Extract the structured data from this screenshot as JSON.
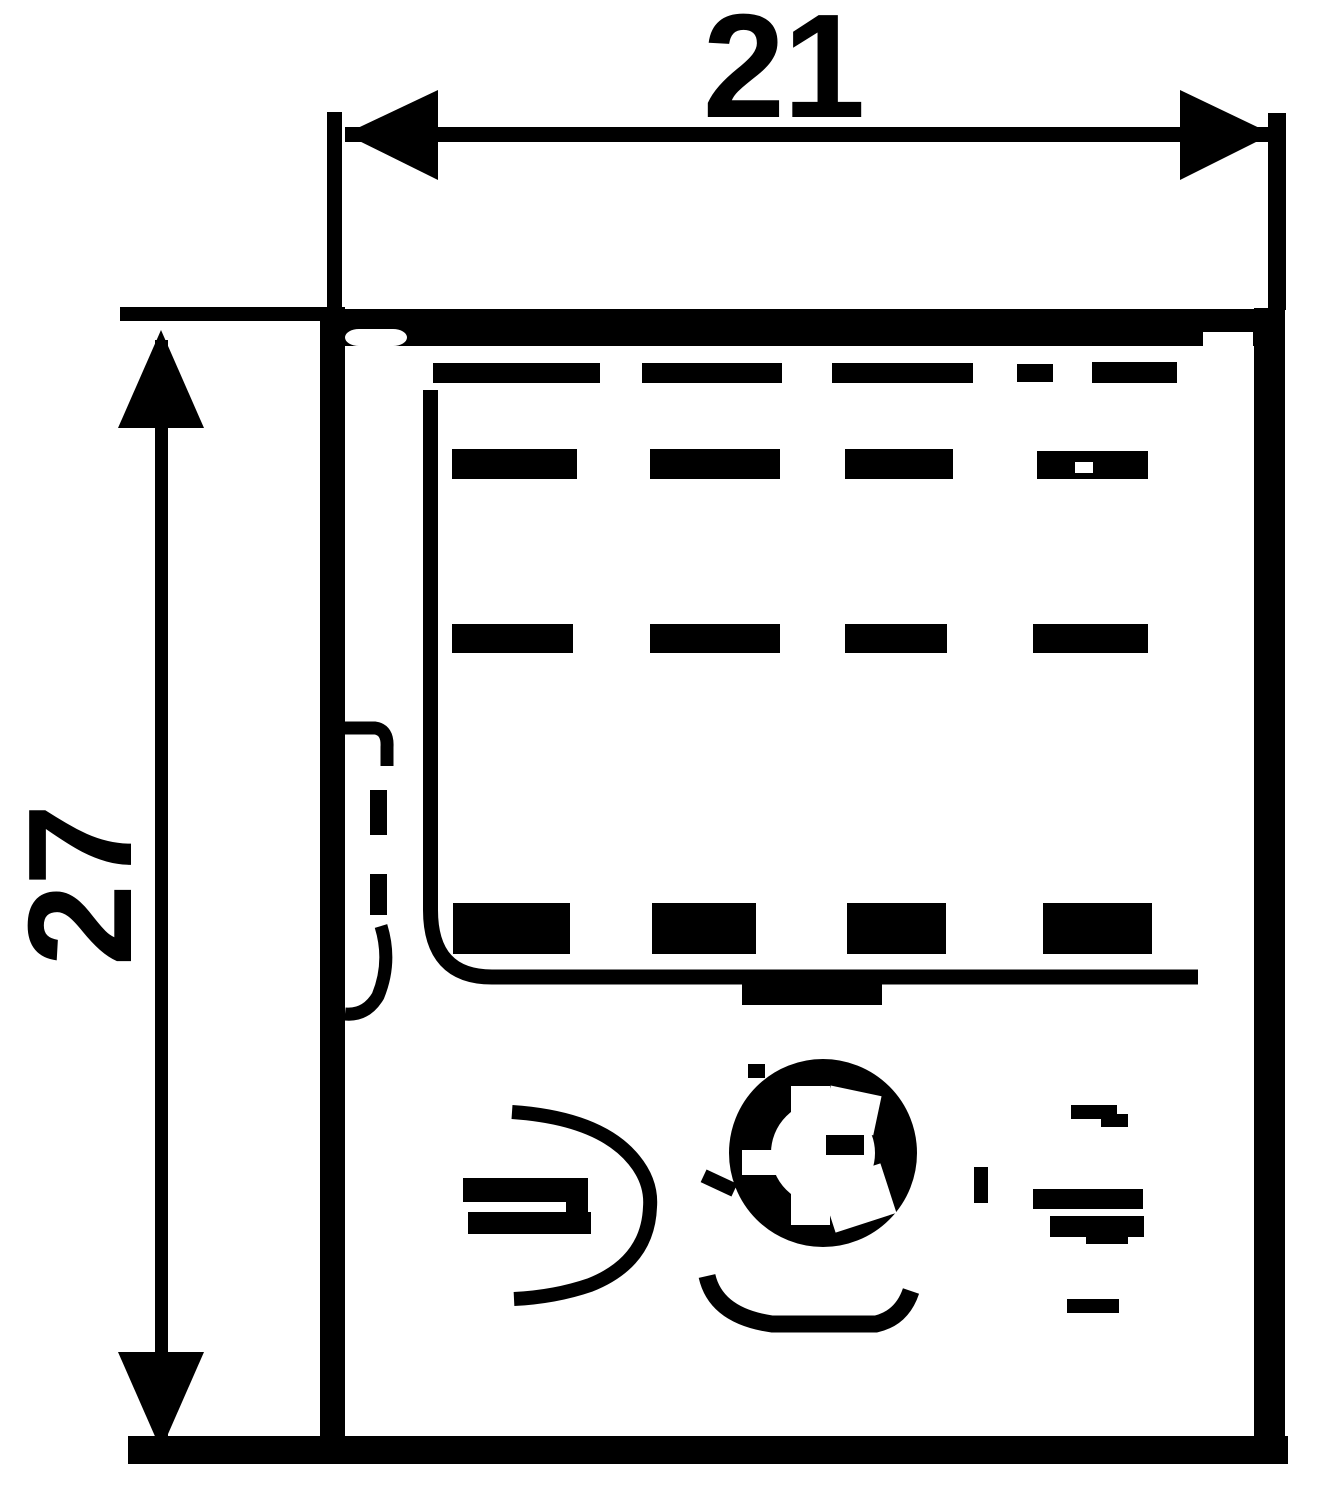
{
  "page": {
    "type": "technical-drawing",
    "ink_color": "#000000",
    "paper_color": "#ffffff"
  },
  "dimensions": {
    "width": {
      "label": "21",
      "orientation": "horizontal"
    },
    "height": {
      "label": "27",
      "orientation": "vertical"
    }
  }
}
